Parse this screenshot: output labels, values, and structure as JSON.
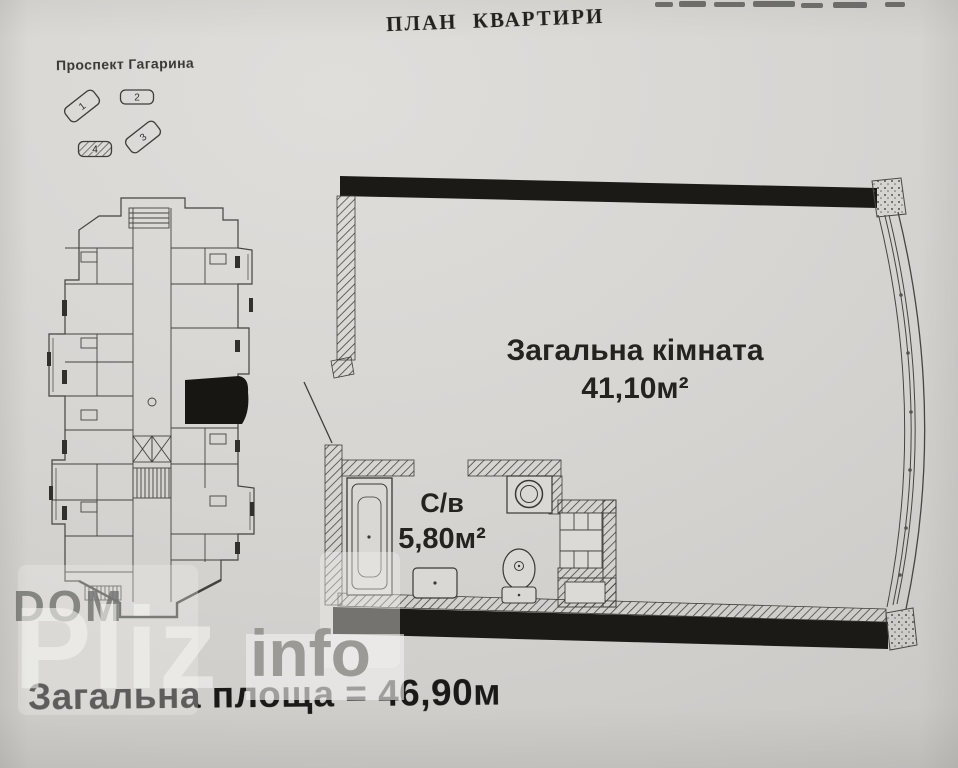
{
  "page": {
    "title": "ПЛАН КВАРТИРИ",
    "total_area_label": "Загальна площа = 46,90м"
  },
  "site_map": {
    "street": "Проспект Гагарина",
    "buildings": [
      {
        "number": "1",
        "highlighted": false
      },
      {
        "number": "2",
        "highlighted": false
      },
      {
        "number": "3",
        "highlighted": false
      },
      {
        "number": "4",
        "highlighted": true
      }
    ]
  },
  "apartment": {
    "rooms": [
      {
        "name": "Загальна кімната",
        "area": "41,10м²"
      },
      {
        "name": "С/в",
        "area": "5,80м²"
      }
    ]
  },
  "watermark": {
    "dom": "DOM",
    "pliz": "Pliz",
    "info": "info"
  },
  "colors": {
    "paper": "#d5d3d0",
    "ink": "#1b1a18"
  }
}
